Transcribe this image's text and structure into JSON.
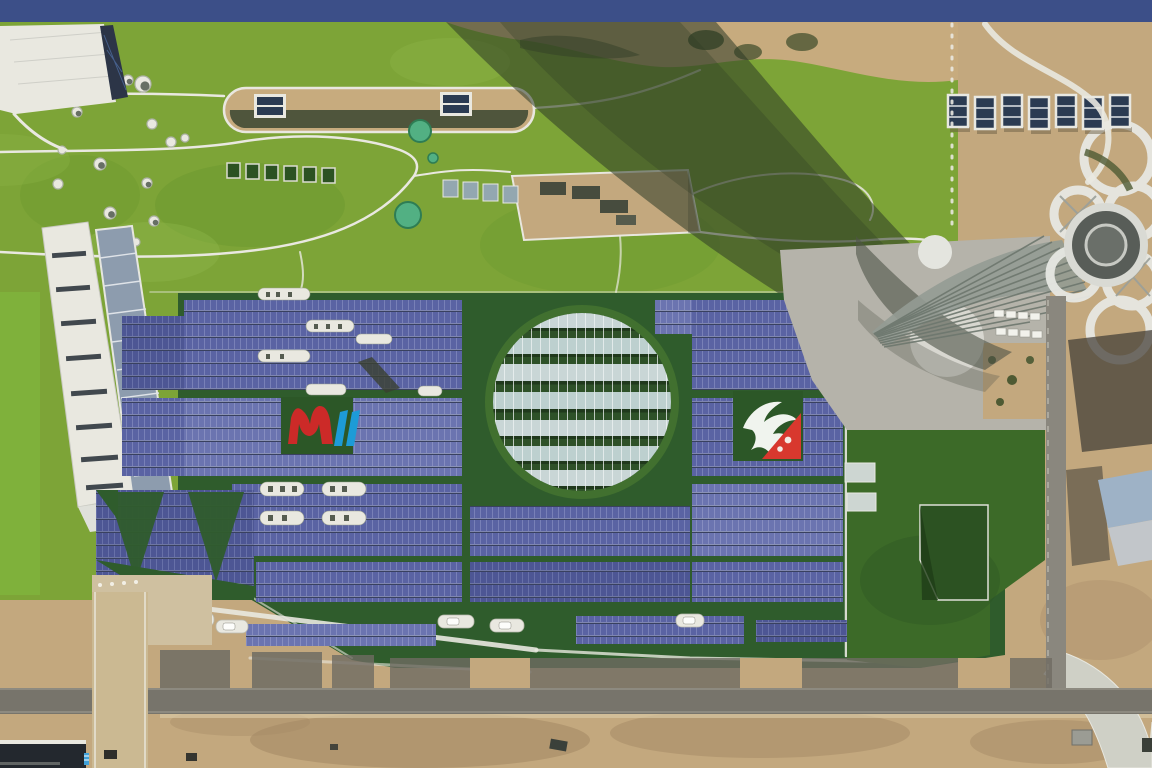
{
  "scene": {
    "type": "aerial-drone-photo",
    "description": "Top-down aerial photograph of a large eco-building with a green (grass) roof park, a huge rooftop solar-panel array with a circular louvred skylight, two rooftop logos, an observation tower with a cable-stayed funnel and clover-shaped head on the right, service roads and bare construction dirt along the bottom and right.",
    "letterbox": {
      "top_bar": "navy strip across full width"
    },
    "features": {
      "roof_park": "sunlit green roof with white footpaths, round skylight domes, mint-green tank domes, a sunken service trench and an equipment platform",
      "tower_shadow": "long diagonal shadow of the tower cast across the green roof",
      "solar_array": "blue-violet photovoltaic panels in horizontal rows with dark turf aisles, chevron-stepped southwest corner and white rooftop openings",
      "circular_skylight": "large circle of horizontal glass louvres set in the panel field",
      "logo_left": "red twin-peak mark beside two slanted blue bars on a green patch",
      "logo_right": "white flying crane above a red triangular pennant with white blossoms on a green patch",
      "east_lawn": "dark green lawn with two glass skylights and a sloped ramp",
      "tower": "steel funnel of radiating cables rising to a white clover observation head, grey plaza, white dome pads, parked cars",
      "skylight_row": "seven framed rooftop skylights on tan gravel, north-east",
      "ground": "tan earth, horizontal asphalt road, side roads, slab pads, scattered vehicles, dark road stub at bottom-left"
    },
    "logos": {
      "left": {
        "shapes": [
          "red double peak",
          "two slanted blue bars"
        ]
      },
      "right": {
        "shapes": [
          "white crane in flight",
          "red triangle pennant",
          "white blossom dots"
        ]
      }
    }
  },
  "colors": {
    "frame_bar": "#3c4f88",
    "grass": "#7da437",
    "grass_bright": "#7fb13b",
    "grass_dark": "#5d8a28",
    "grass_light": "#9dbf55",
    "turf": "#2f5c2c",
    "lawn": "#3c6a28",
    "lawn_dark": "#2c5222",
    "panel": "#5a63a3",
    "panel_light": "#6b74b0",
    "panel_dark": "#4d5694",
    "panel_grid": "#8e96c6",
    "panel_row": "#39415f",
    "dirt": "#c3a87e",
    "dirt_dark": "#a58a66",
    "dirt_light": "#d8c7a4",
    "tan_band": "#c7ab7e",
    "road": "#77746b",
    "concrete": "#b5b3aa",
    "white": "#e9e8e0",
    "shadow": "#2e3a26",
    "glass": "#c9d6d6",
    "glass_alt": "#bdd0cf",
    "mint": "#52b083",
    "steel": "#939b93",
    "rib": "#6d776e",
    "skylight_frame": "#2b3b52",
    "dark_road": "#23282e",
    "logo_red": "#cc2a28",
    "logo_blue": "#1d9bd7",
    "flag_red": "#d8382e",
    "logo_patch": "#2c5727"
  }
}
